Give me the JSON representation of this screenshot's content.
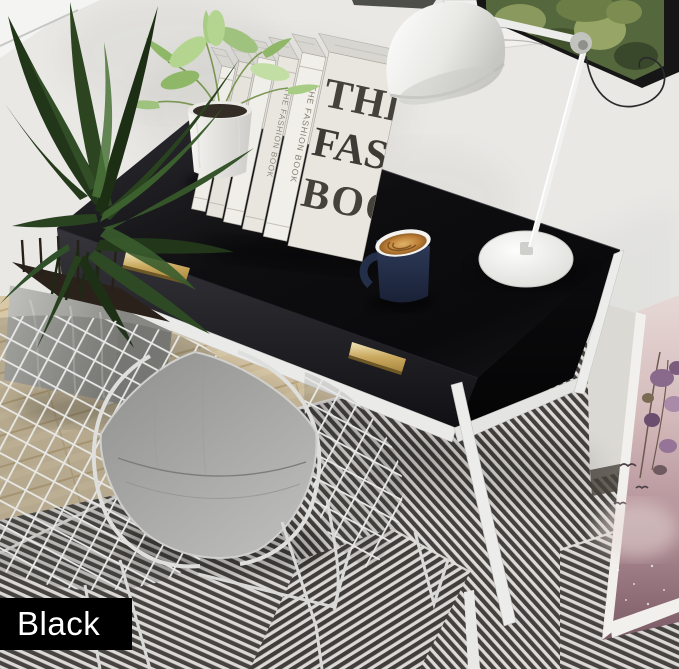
{
  "meta": {
    "type": "product-photo",
    "subject": "Black writing desk with two gold drawer handles styled in a home office with wire chair, task lamp, fashion books and plants"
  },
  "variant_label": {
    "text": "Black",
    "background": "#000000",
    "color": "#ffffff"
  },
  "books": {
    "spine_title": "THE FASHION BOOK",
    "cover_lines": [
      "THE",
      "FASH",
      "BOO"
    ],
    "count": 6
  },
  "palette": {
    "wall": "#e9e8e5",
    "desk_black": "#101012",
    "handle_gold": "#c9a95f",
    "metal_frame_white": "#ececea",
    "floor_wood": "#d9c8a6",
    "rug_dark": "#474441",
    "rug_light": "#e9e7e3",
    "cushion_gray": "#a5a5a3",
    "mug_navy": "#26304b",
    "mug_gold": "#c08138",
    "lamp_white": "#f4f4f2",
    "plant_green": "#2e4a24",
    "poster_pink": "#c4a0a5",
    "frame_black": "#1a1a1a",
    "baseboard_brown": "#5d4a3a"
  },
  "objects": [
    "wall",
    "wood-floor",
    "striped-rug",
    "area-plant",
    "concrete-planter",
    "black-desk",
    "gold-drawer-handle-left",
    "gold-drawer-handle-right",
    "white-metal-frame",
    "fashion-book-stack",
    "potted-plant",
    "navy-mug",
    "white-task-lamp",
    "wire-chair",
    "gray-seat-cushion",
    "green-botanical-art",
    "white-sketch-art",
    "pink-floral-poster",
    "variant-label"
  ]
}
